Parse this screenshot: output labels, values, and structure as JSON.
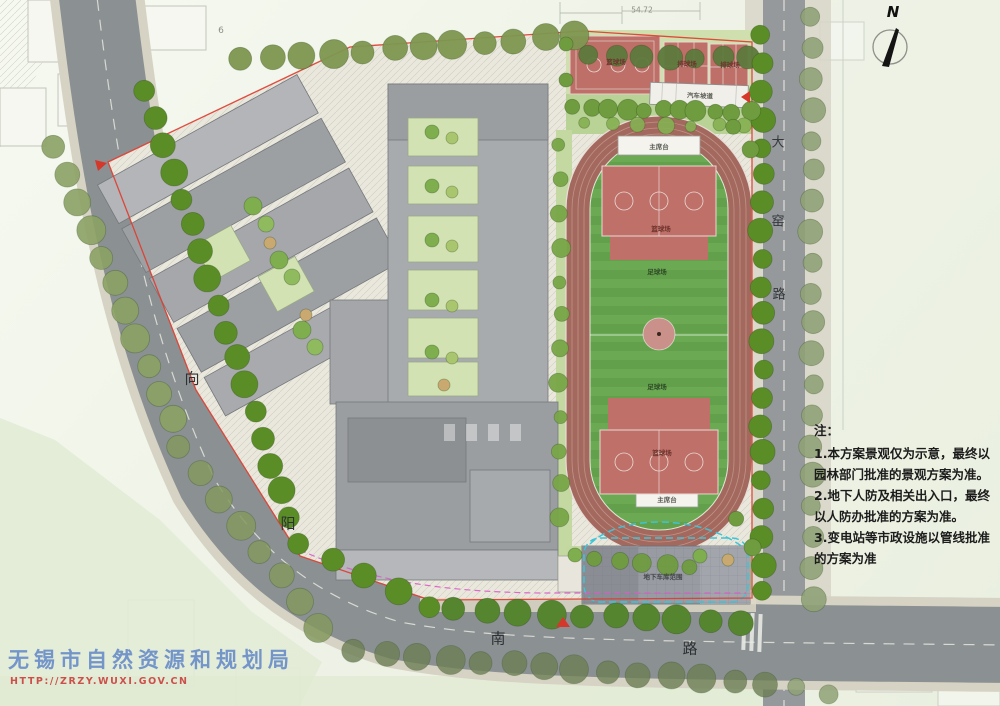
{
  "watermark": {
    "agency": "无锡市自然资源和规划局",
    "url": "HTTP://ZRZY.WUXI.GOV.CN"
  },
  "compass": {
    "north_label": "N"
  },
  "notes": {
    "heading": "注：",
    "line1": "1.本方案景观仅为示意，最终以园林部门批准的景观方案为准。",
    "line2": "2.地下人防及相关出入口，最终以人防办批准的方案为准。",
    "line3": "3.变电站等市政设施以管线批准的方案为准"
  },
  "roads": {
    "xiangyang": {
      "char1": "向",
      "char2": "阳"
    },
    "nan": {
      "char1": "南",
      "char2": "路"
    },
    "dayao": {
      "char1": "大",
      "char2": "窑",
      "char3": "路"
    }
  },
  "facilities": {
    "basketball_nw": "篮球场",
    "volleyball_1": "排球场",
    "volleyball_2": "排球场",
    "car_ramp": "汽车坡道",
    "rostrum_north": "主席台",
    "rostrum_south": "主席台",
    "basketball_north": "篮球场",
    "basketball_south": "篮球场",
    "football_north": "足球场",
    "football_south": "足球场",
    "underground_garage": "地下车库范围"
  },
  "annotations": {
    "dimension_top": "54.72",
    "block_no": "6"
  },
  "colors": {
    "track": "#a4695e",
    "field": "#63a04b",
    "court": "#bf7069",
    "street_tree": "#5b8d27",
    "road": "#8b9092",
    "boundary_red": "#e03a2e",
    "garage_line_cyan": "#3ec4d6",
    "watermark_blue": "#567ec6",
    "watermark_red": "#c93939"
  }
}
